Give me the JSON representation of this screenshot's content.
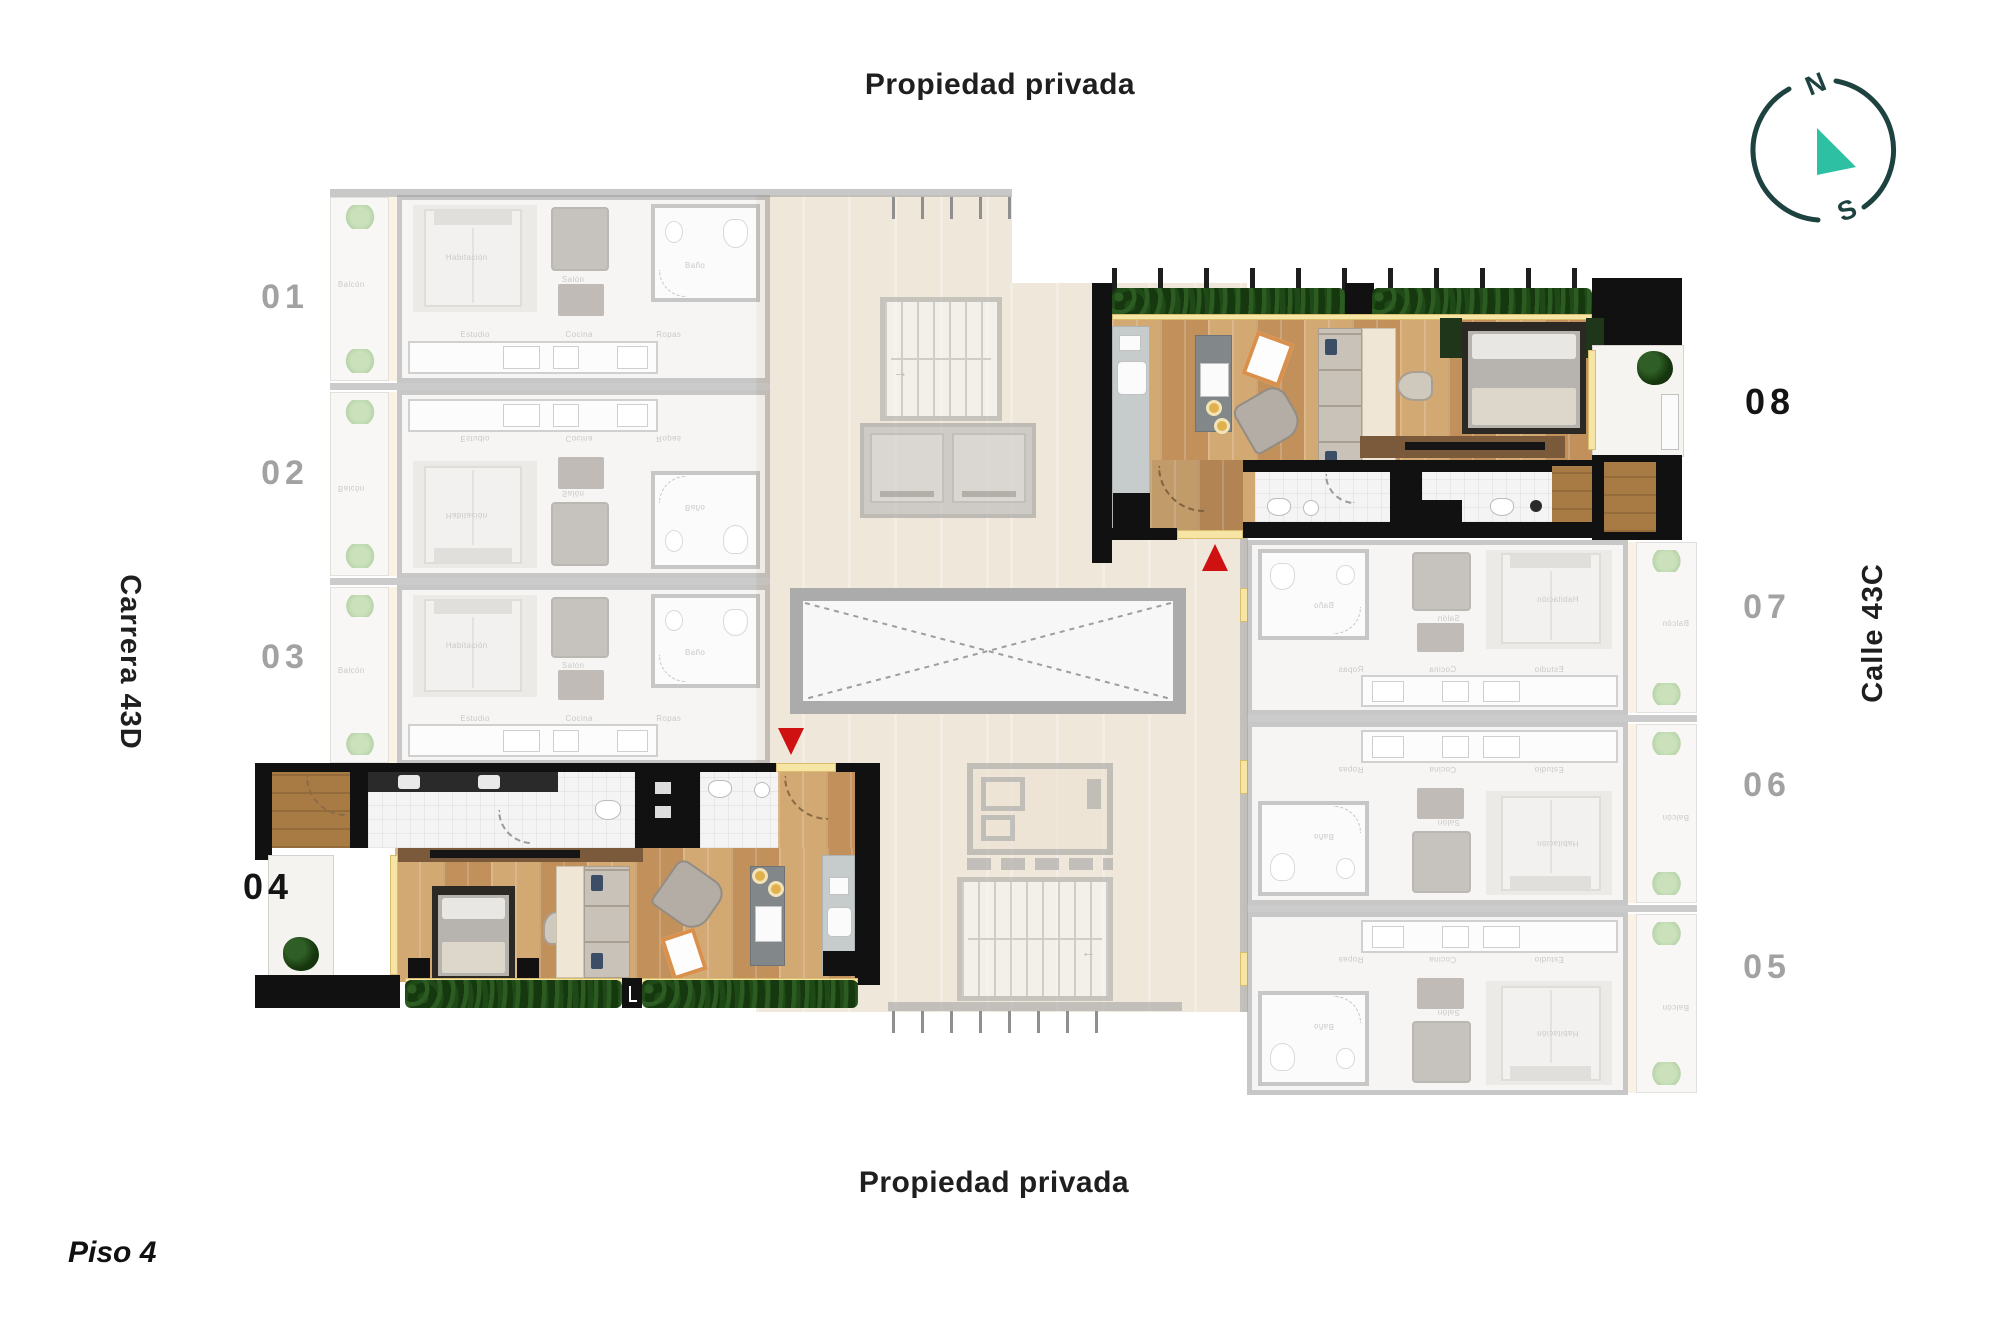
{
  "titles": {
    "top": "Propiedad privada",
    "bottom": "Propiedad privada",
    "floor": "Piso 4"
  },
  "streets": {
    "left": "Carrera 43D",
    "right": "Calle 43C"
  },
  "compass": {
    "north": "N",
    "south": "S"
  },
  "units": {
    "u01": {
      "label": "01",
      "highlighted": false
    },
    "u02": {
      "label": "02",
      "highlighted": false
    },
    "u03": {
      "label": "03",
      "highlighted": false
    },
    "u04": {
      "label": "04",
      "highlighted": true
    },
    "u05": {
      "label": "05",
      "highlighted": false
    },
    "u06": {
      "label": "06",
      "highlighted": false
    },
    "u07": {
      "label": "07",
      "highlighted": false
    },
    "u08": {
      "label": "08",
      "highlighted": true
    }
  },
  "rooms": {
    "bedroom": "Habitación",
    "living": "Salón",
    "bathroom": "Baño",
    "study": "Estudio",
    "kitchen": "Cocina",
    "laundry": "Ropas",
    "balcony": "Balcón"
  },
  "colors": {
    "marker_red": "#cf1111",
    "compass_ring": "#1d4240",
    "compass_needle": "#2ec0a2",
    "hedge_green": "#16380f",
    "wood": "#cda26c",
    "corridor_beige": "#efe7da",
    "faded_wall_gray": "#9b9b9b",
    "highlight_wall_black": "#111111",
    "sill_yellow": "#f6e5a4"
  }
}
